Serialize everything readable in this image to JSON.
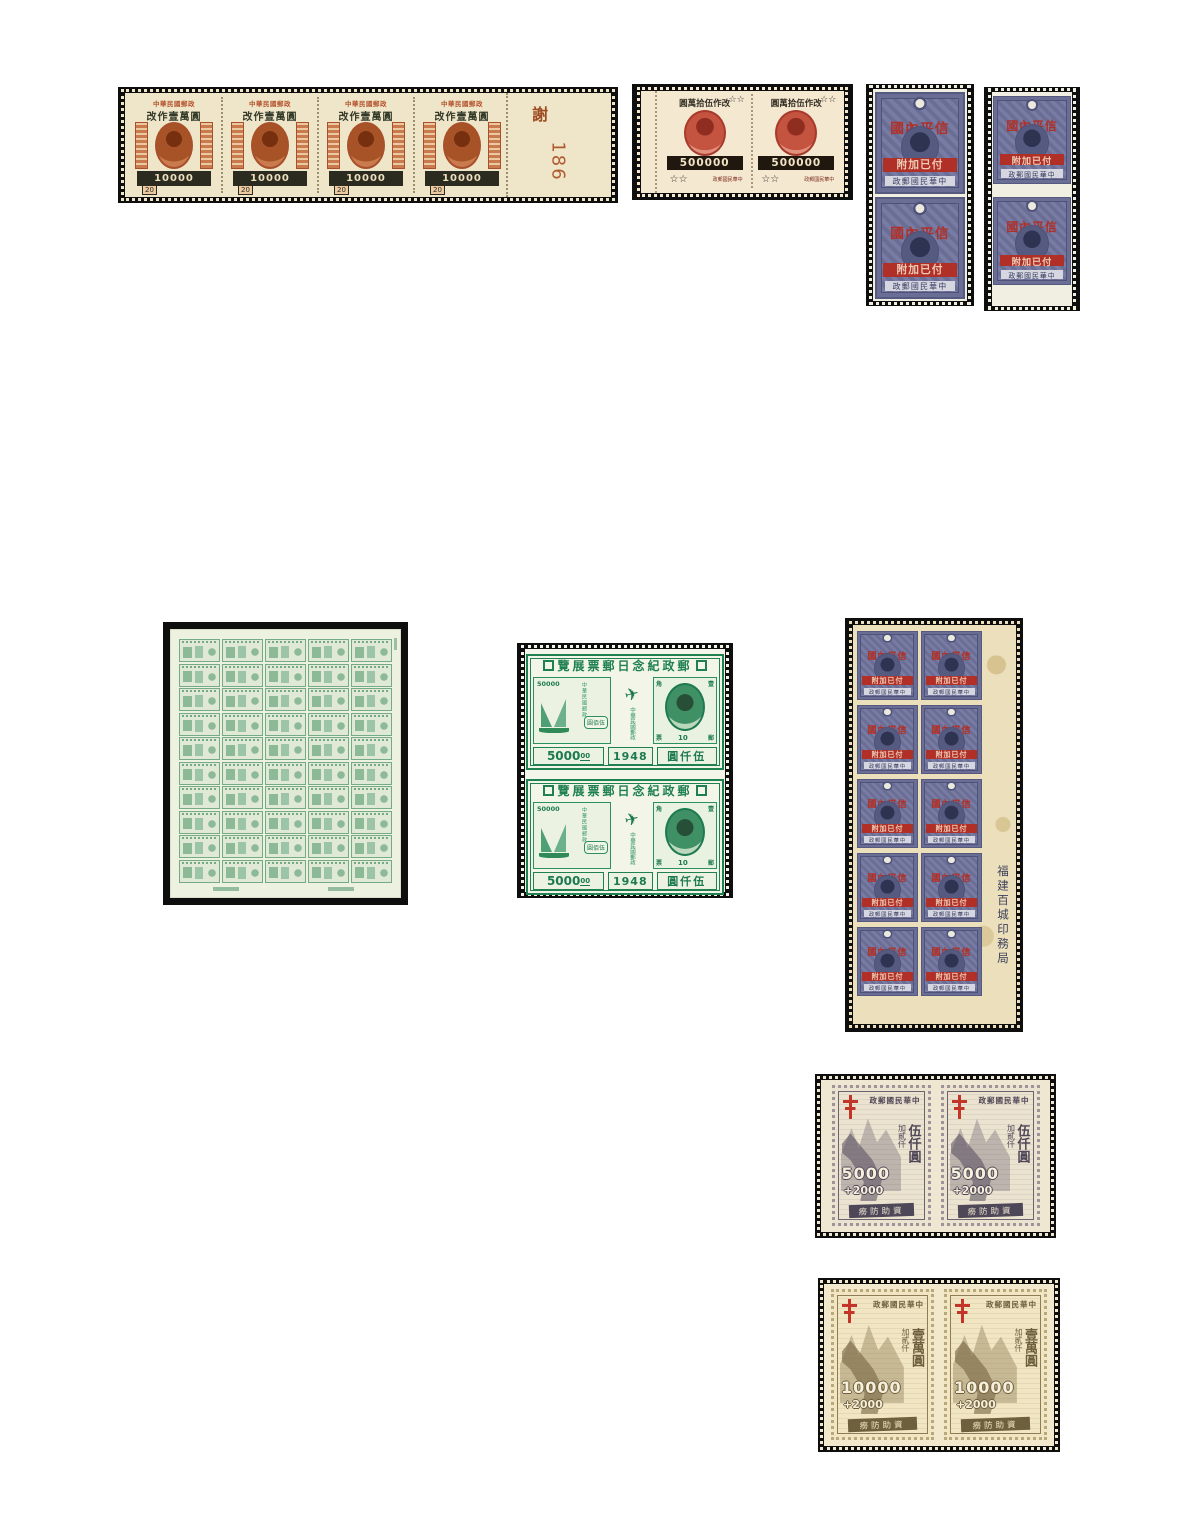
{
  "page": {
    "background": "#ffffff",
    "description_note": ""
  },
  "strip": {
    "count": 4,
    "country_header": "中華民國郵政",
    "overprint": "改作壹萬圓",
    "surcharge": "10000",
    "base_value": "20",
    "selvage_char": "謝",
    "plate_number": "186",
    "stamp_color": "#b4542e",
    "paper_color": "#efe5c8"
  },
  "red_pair": {
    "count": 2,
    "overprint": "圓萬拾伍作改",
    "stars_top": "☆☆",
    "surcharge": "500000",
    "stars_bottom": "☆☆",
    "bottom_chars": "政郵國民華中",
    "stamp_color": "#c4533f"
  },
  "blue": {
    "pair_count": 2,
    "block_rows": 5,
    "block_cols": 2,
    "overprint_top": "國內平信",
    "overprint_bar": "附加已付",
    "bottom_band": "政郵國民華中",
    "block_margin_text": "福建百城印務局",
    "stamp_color": "#6a6e95",
    "overprint_color": "#b03028"
  },
  "green_sheet": {
    "rows": 10,
    "cols": 5,
    "stamp_color": "#74ab85"
  },
  "green_pair": {
    "count": 2,
    "banner": "覽展票郵日念紀政郵",
    "inner_value": "50000",
    "inner_box": "圓佰伍",
    "side_column": "中華民國郵政",
    "portrait_corners": [
      "角",
      "壹",
      "票",
      "郵"
    ],
    "portrait_value": "10",
    "bottom_value": "5000",
    "bottom_value_sup": "00",
    "bottom_year": "1948",
    "bottom_chars": "圓仟伍",
    "stamp_color": "#1f8050"
  },
  "tb_gray": {
    "count": 2,
    "header": "政郵國民華中",
    "surcharge_small": "加貳仟",
    "surcharge_large": "伍仟圓",
    "value": "5000",
    "added": "+2000",
    "bottom_band": "癆防助資",
    "ink_color": "#6b6370",
    "cross_color": "#c23528"
  },
  "tb_brown": {
    "count": 2,
    "header": "政郵國民華中",
    "surcharge_small": "加貳仟",
    "surcharge_large": "壹萬圓",
    "value": "10000",
    "added": "+2000",
    "bottom_band": "癆防助資",
    "ink_color": "#8d7c55",
    "cross_color": "#c23528"
  }
}
